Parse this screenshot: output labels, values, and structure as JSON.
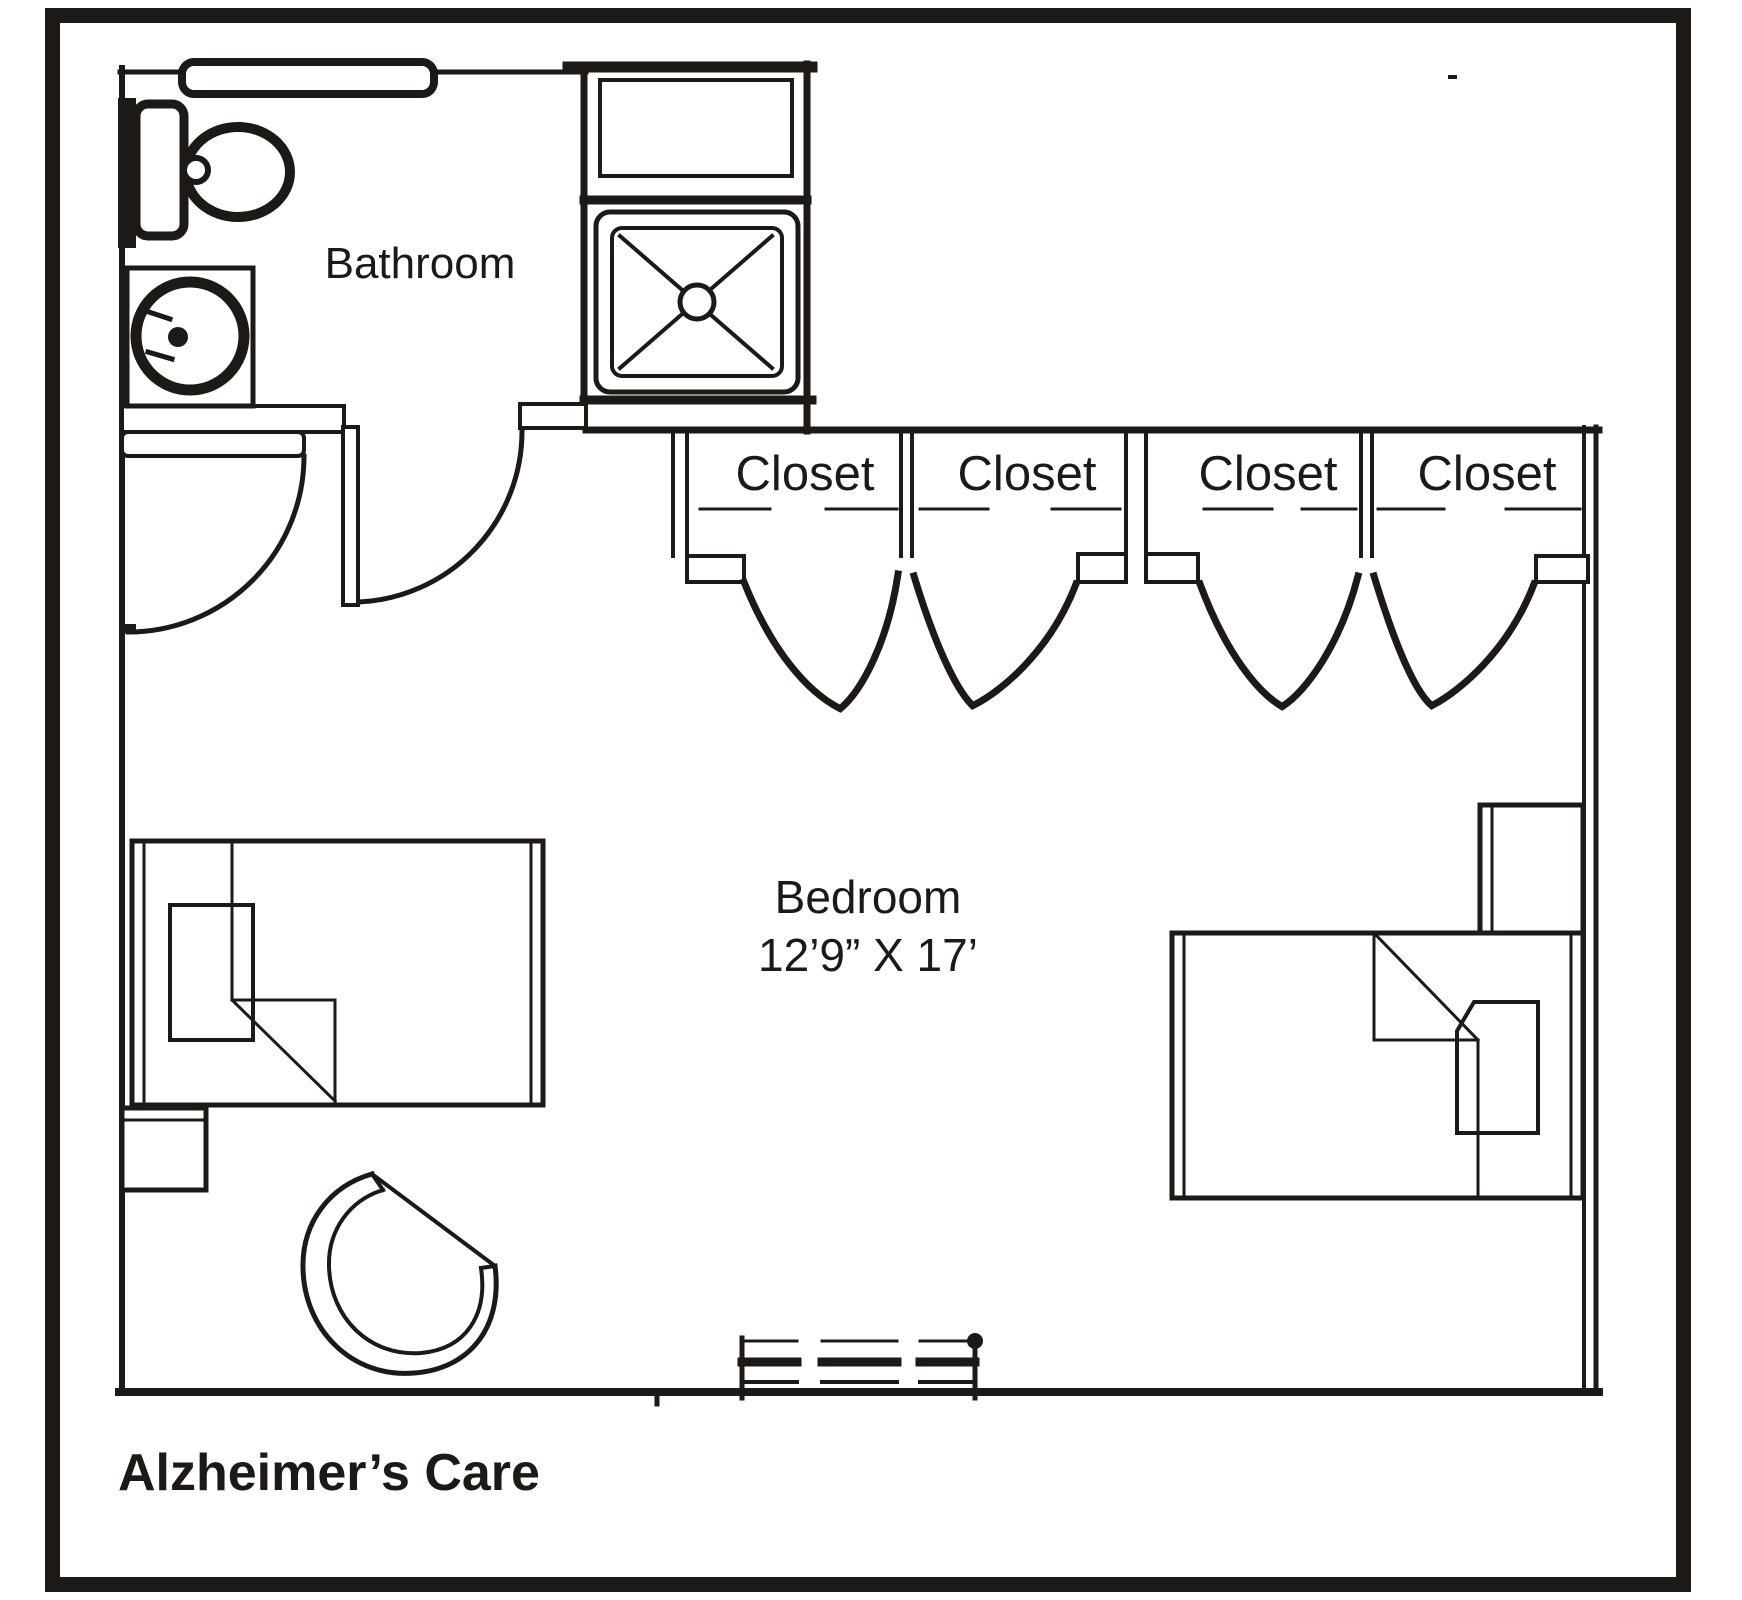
{
  "title": "Alzheimer’s Care",
  "rooms": {
    "bathroom": {
      "label": "Bathroom"
    },
    "bedroom": {
      "label": "Bedroom",
      "dimensions": "12’9” X 17’"
    },
    "closets": {
      "labels": [
        "Closet",
        "Closet",
        "Closet",
        "Closet"
      ]
    }
  },
  "fixtures": {
    "toilet": "toilet",
    "sink": "sink-vanity",
    "shower": "shower-stall",
    "beds": [
      "twin-bed-left",
      "twin-bed-right"
    ],
    "nightstands": [
      "nightstand-left",
      "nightstand-right"
    ],
    "chair": "tub-chair",
    "window": "bottom-wall-window"
  },
  "colors": {
    "ink": "#1c1916",
    "frame": "#231e19",
    "background": "#ffffff"
  }
}
